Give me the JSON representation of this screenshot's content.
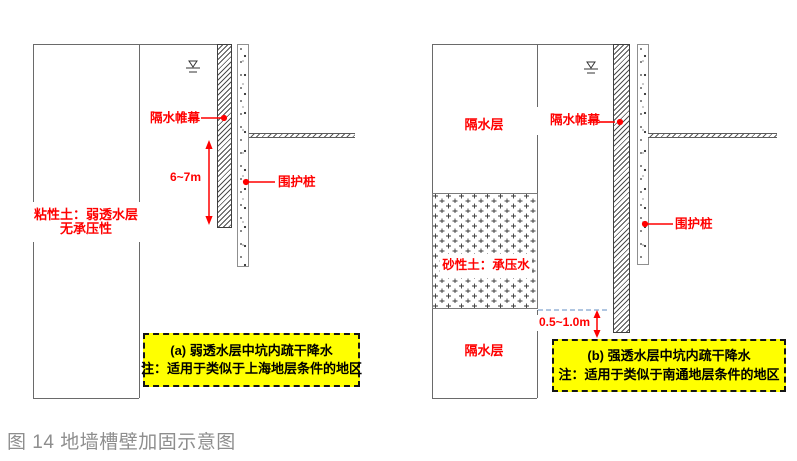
{
  "figure": {
    "caption": "图 14 地墙槽壁加固示意图"
  },
  "colors": {
    "label_red": "#ff0000",
    "note_bg": "#ffff00",
    "note_border": "#141414",
    "caption_gray": "#8e8e8e",
    "outline_gray": "#6a6a6a",
    "water_dash_blue": "#95b3d7"
  },
  "icons": {
    "water_table": "groundwater-level-symbol",
    "leader_dot": "red-dot-leader",
    "dimension_arrow": "double-headed-arrow"
  },
  "left": {
    "soil_label_line1": "粘性土：弱透水层",
    "soil_label_line2": "无承压性",
    "curtain_label": "隔水帷幕",
    "pile_label": "围护桩",
    "dimension_label": "6~7m",
    "note_title": "(a) 弱透水层中坑内疏干降水",
    "note_text": "注：适用于类似于上海地层条件的地区"
  },
  "right": {
    "upper_layer_label": "隔水层",
    "sand_layer_label": "砂性土：承压水",
    "lower_layer_label": "隔水层",
    "curtain_label": "隔水帷幕",
    "pile_label": "围护桩",
    "dimension_label": "0.5~1.0m",
    "note_title": "(b) 强透水层中坑内疏干降水",
    "note_text": "注：适用于类似于南通地层条件的地区"
  }
}
